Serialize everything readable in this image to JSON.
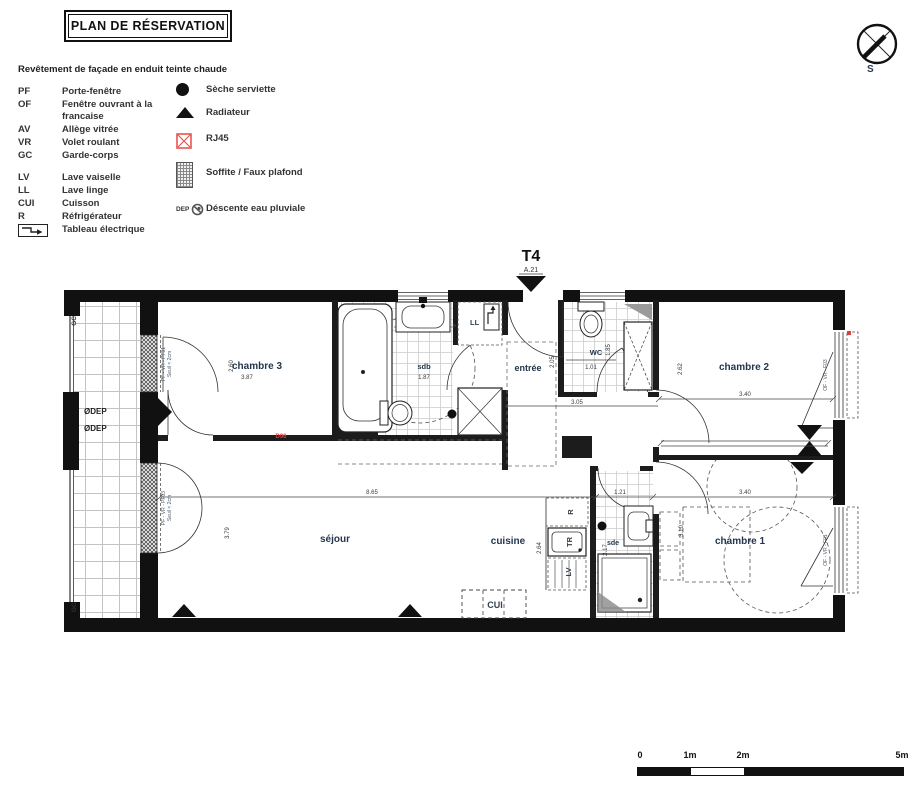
{
  "title": "PLAN DE RÉSERVATION",
  "facade_note": "Revêtement de façade en enduit teinte chaude",
  "compass_label": "S",
  "legend": {
    "abbreviations": [
      {
        "code": "PF",
        "label": "Porte-fenêtre"
      },
      {
        "code": "OF",
        "label": "Fenêtre ouvrant à la francaise"
      },
      {
        "code": "AV",
        "label": "Allège vitrée"
      },
      {
        "code": "VR",
        "label": "Volet roulant"
      },
      {
        "code": "GC",
        "label": "Garde-corps"
      },
      {
        "code": "LV",
        "label": "Lave vaiselle"
      },
      {
        "code": "LL",
        "label": "Lave linge"
      },
      {
        "code": "CUI",
        "label": "Cuisson"
      },
      {
        "code": "R",
        "label": "Réfrigérateur"
      },
      {
        "code": "",
        "label": "Tableau électrique"
      }
    ],
    "symbols": [
      {
        "label": "Sèche serviette"
      },
      {
        "label": "Radiateur"
      },
      {
        "label": "RJ45"
      },
      {
        "label": "Soffite / Faux plafond"
      },
      {
        "label": "Déscente eau pluviale",
        "prefix": "DEP"
      }
    ]
  },
  "unit": {
    "type": "T4",
    "lot": "A.21"
  },
  "rooms": {
    "chambre3": {
      "name": "chambre 3",
      "dw": "3.87",
      "dh": "2.60"
    },
    "sdb": {
      "name": "sdb",
      "dw": "1.87"
    },
    "entree": {
      "name": "entrée",
      "dh": "2.05",
      "hall_dim": "3.05"
    },
    "wc": {
      "name": "WC",
      "dw": "1.01",
      "dh": "1.85"
    },
    "chambre2": {
      "name": "chambre 2",
      "dw": "3.40",
      "dh": "2.62"
    },
    "sejour": {
      "name": "séjour",
      "dw": "8.65",
      "dh": "3.79"
    },
    "cuisine": {
      "name": "cuisine",
      "dh": "2.64"
    },
    "sde": {
      "name": "sde",
      "dw": "1.21",
      "dh": "2.17"
    },
    "chambre1": {
      "name": "chambre 1",
      "dw": "3.40",
      "dh": "3.10"
    }
  },
  "fixtures": {
    "ll": "LL",
    "r": "R",
    "tr": "TR",
    "lv": "LV",
    "cui": "CUI"
  },
  "openings": {
    "pf01": {
      "l1": "PF - VR - PF01",
      "l2": "Seuil < 2cm"
    },
    "pf03": {
      "l1": "PF - VR - PF03",
      "l2": "Seuil < 2cm"
    },
    "f03": "OF - VR - F03",
    "f01": "OF - VR - F01"
  },
  "annotations": {
    "gc": "GC",
    "dep1": "ØDEP",
    "dep2": "ØDEP",
    "red_mark": "D96"
  },
  "scale_bar": {
    "ticks": [
      "0",
      "1m",
      "2m",
      "5m"
    ]
  },
  "colors": {
    "wall": "#111111",
    "accent_red": "#e23d3d",
    "room_label": "#24364e"
  }
}
